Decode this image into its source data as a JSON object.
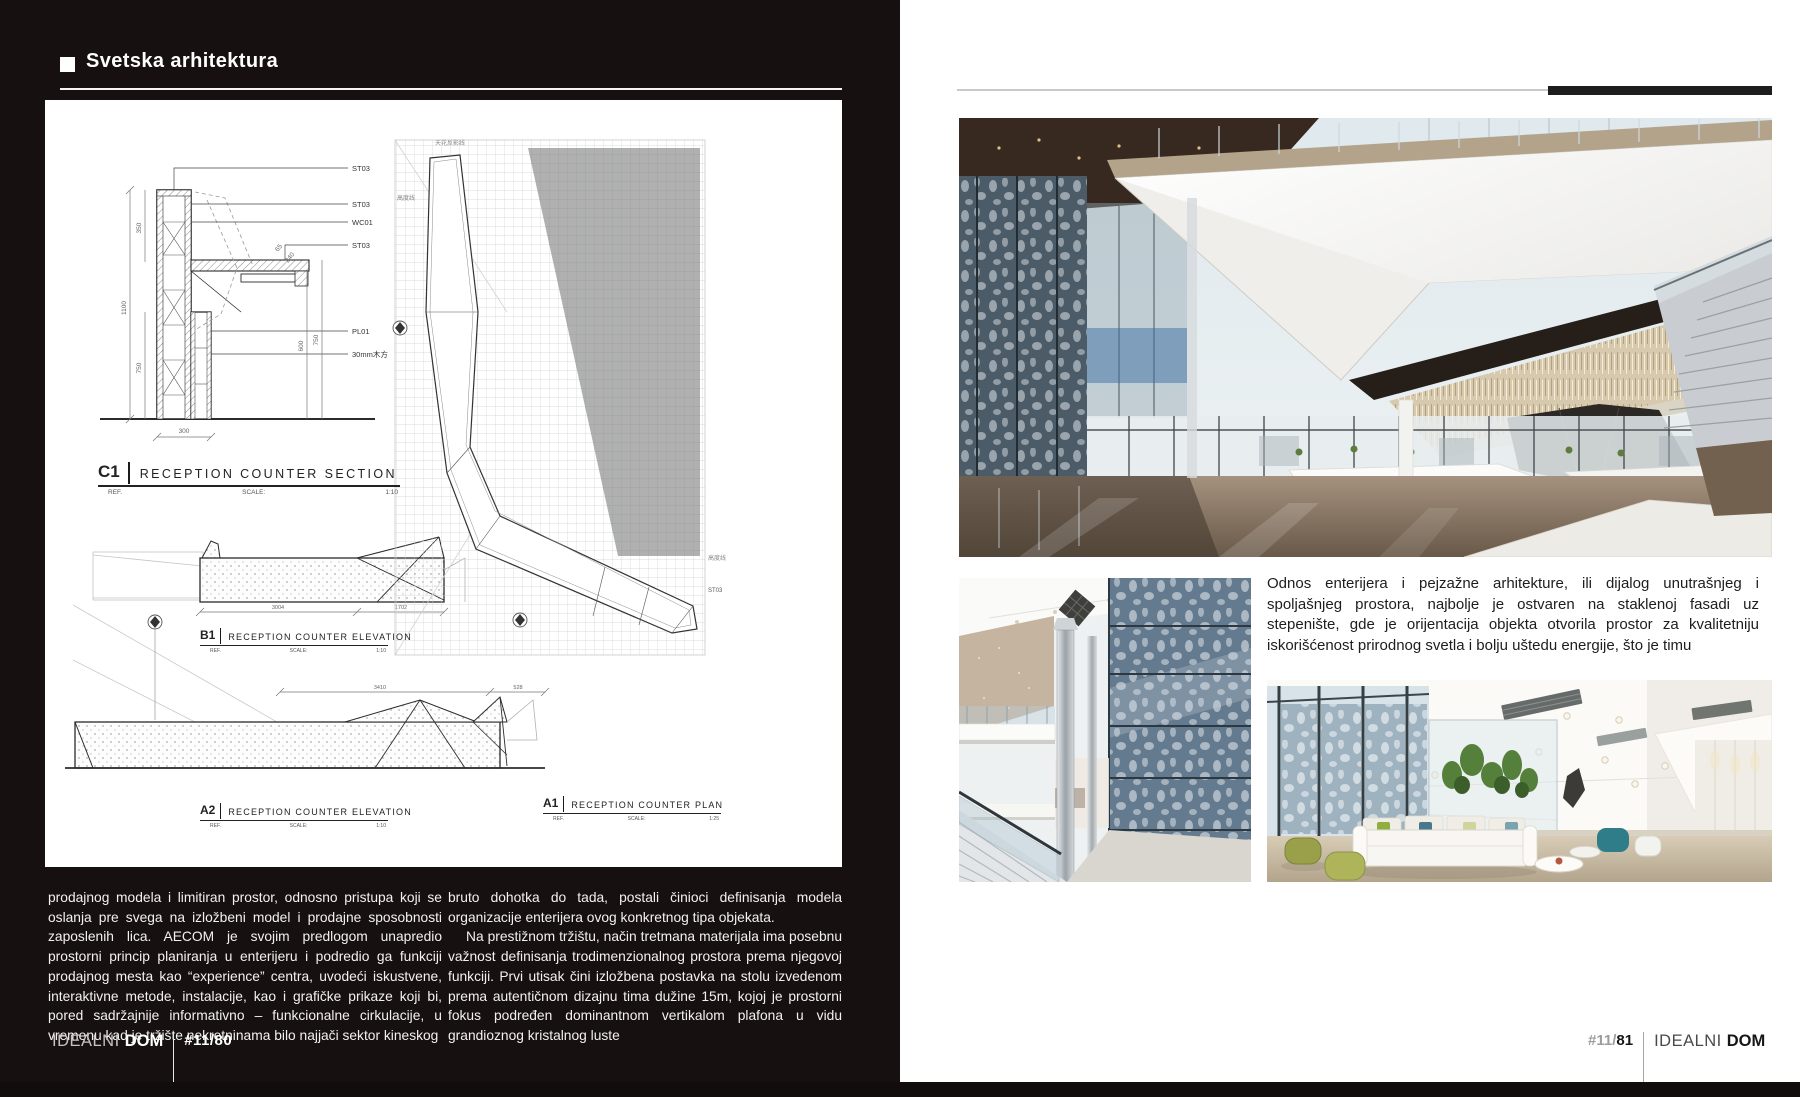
{
  "header": {
    "title": "Svetska arhitektura"
  },
  "drawings": {
    "section": {
      "code": "C1",
      "title": "RECEPTION COUNTER SECTION",
      "ref": "REF.",
      "scale_label": "SCALE:",
      "scale": "1:10",
      "labels": [
        "ST03",
        "ST03",
        "WC01",
        "ST03",
        "PL01",
        "30mm木方"
      ],
      "dims": {
        "total_height": "1100",
        "upper": "350",
        "lower": "750",
        "width": "300",
        "d65": "65",
        "d240": "240",
        "d600": "600",
        "d750": "750"
      }
    },
    "b1": {
      "code": "B1",
      "title": "RECEPTION COUNTER ELEVATION",
      "ref": "REF.",
      "scale_label": "SCALE:",
      "scale": "1:10",
      "dims": {
        "a": "3004",
        "b": "1702"
      }
    },
    "a2": {
      "code": "A2",
      "title": "RECEPTION COUNTER ELEVATION",
      "ref": "REF.",
      "scale_label": "SCALE:",
      "scale": "1:10",
      "dims": {
        "a": "3410",
        "b": "528"
      }
    },
    "a1": {
      "code": "A1",
      "title": "RECEPTION COUNTER PLAN",
      "ref": "REF.",
      "scale_label": "SCALE:",
      "scale": "1:25",
      "annotations": {
        "ceiling": "天花反影线",
        "height1": "高度线",
        "height2": "高度线",
        "st03": "ST03"
      }
    }
  },
  "body": {
    "col1": "prodajnog modela i limitiran prostor, odnosno pristupa koji se oslanja pre svega na izložbeni model i prodajne sposobnosti zaposlenih lica. AECOM je svojim predlogom unapredio prostorni princip planiranja u enterijeru i podredio ga funkciji prodajnog mesta kao “experience” centra, uvodeći iskustvene, interaktivne metode, instalacije, kao i grafičke prikaze koji bi, pored sadržajnije informativno – funkcionalne cirkulacije, u vremenu kad je tržište nekretninama bilo najjači sektor kineskog",
    "col2_p1": "bruto dohotka do tada, postali činioci definisanja modela organizacije enterijera ovog konkretnog tipa objekata.",
    "col2_p2": "Na prestižnom tržištu, način tretmana materijala ima posebnu važnost definisanja trodimenzionalnog prostora prema njegovoj funkciji. Prvi utisak čini izložbena postavka na stolu izvedenom prema autentičnom dizajnu tima dužine 15m, kojoj je prostorni fokus podređen dominantnom vertikalom plafona u vidu grandioznog kristalnog luste"
  },
  "article": {
    "text": "Odnos enterijera i pejzažne arhitekture, ili dijalog unutrašnjeg i spoljašnjeg prostora, najbolje je ostvaren na staklenoj fasadi uz stepenište, gde je orijentacija objekta otvorila prostor za kvalitetniju iskorišćenost prirodnog svetla i bolju uštedu energije, što je timu"
  },
  "footer_left": {
    "brand": "IDEALNI",
    "brand_bold": "DOM",
    "issue": "#11/80"
  },
  "footer_right": {
    "issue_prefix": "#11/",
    "issue_number": "81",
    "brand": "IDEALNI",
    "brand_bold": "DOM"
  },
  "colors": {
    "page_black": "#161110",
    "rule_black": "#1d1d1d",
    "rule_gray": "#c9c9c9"
  }
}
